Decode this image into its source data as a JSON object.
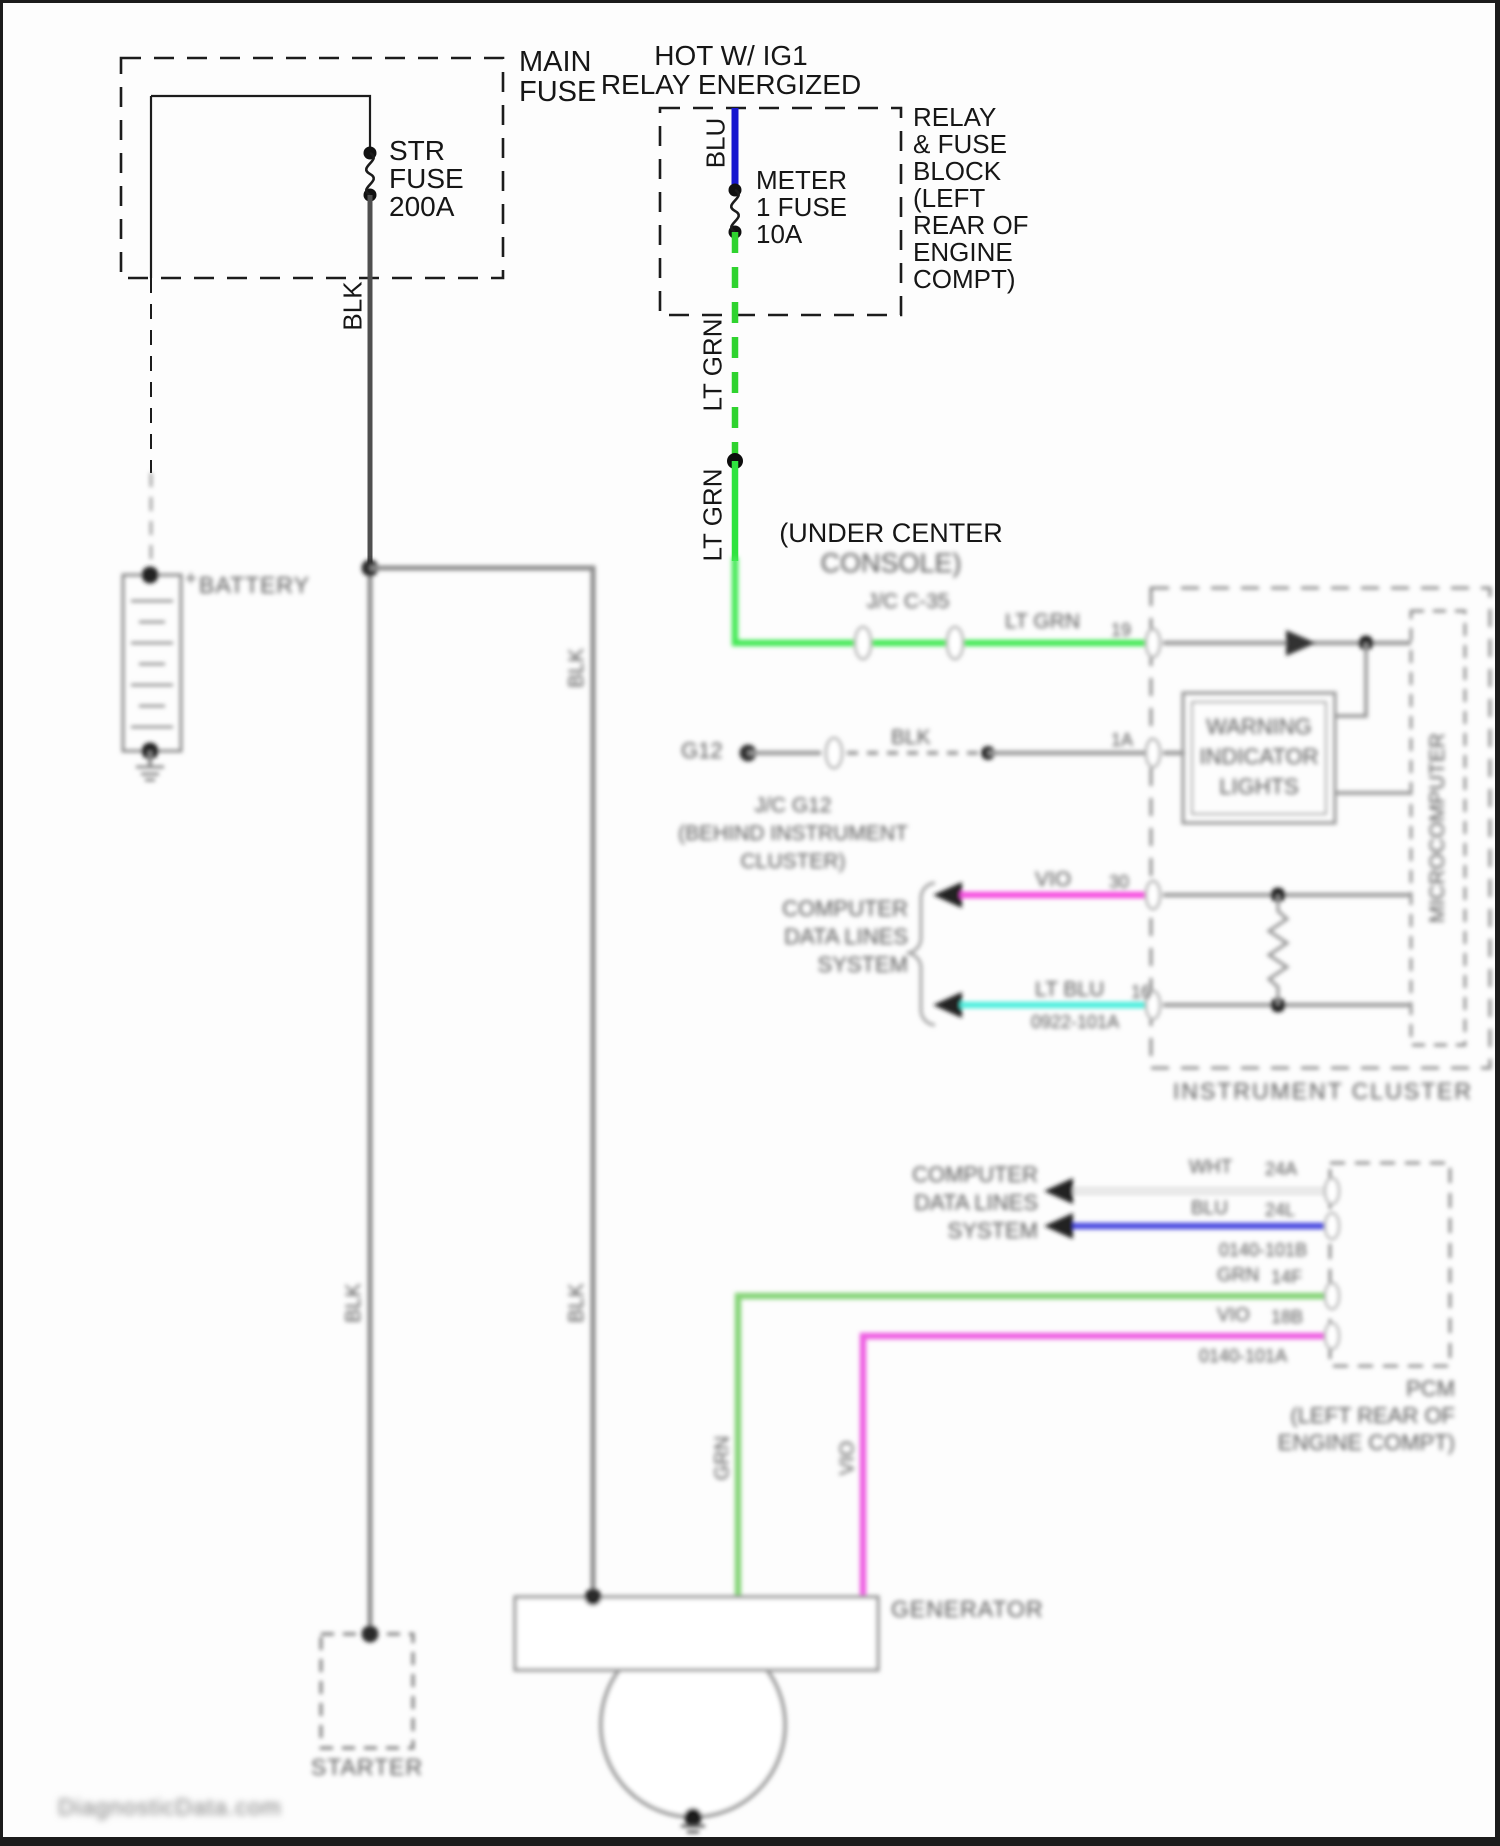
{
  "top": {
    "main_fuse": [
      "MAIN",
      "FUSE"
    ],
    "str_fuse": [
      "STR",
      "FUSE",
      "200A"
    ],
    "hot_header": [
      "HOT W/ IG1",
      "RELAY ENERGIZED"
    ],
    "relay_block": [
      "RELAY",
      "& FUSE",
      "BLOCK",
      "(LEFT",
      "REAR OF",
      "ENGINE",
      "COMPT)"
    ],
    "meter_fuse": [
      "METER",
      "1 FUSE",
      "10A"
    ],
    "blu": "BLU",
    "blk": "BLK",
    "lt_grn_upper": "LT GRN",
    "lt_grn_lower": "LT GRN",
    "under_center": [
      "(UNDER CENTER",
      "CONSOLE)"
    ]
  },
  "left": {
    "battery_plus": "+",
    "battery": "BATTERY",
    "starter": "STARTER",
    "blk_main_lower": "BLK",
    "blk_branch_upper": "BLK",
    "blk_branch_lower": "BLK"
  },
  "cluster": {
    "jc_c35": "J/C C-35",
    "lt_grn": "LT GRN",
    "lt_grn_pin": "19",
    "g12": "G12",
    "blk": "BLK",
    "blk_pin": "1A",
    "jc_g12": [
      "J/C G12",
      "(BEHIND INSTRUMENT",
      "CLUSTER)"
    ],
    "computer_data_lines": [
      "COMPUTER",
      "DATA LINES",
      "SYSTEM"
    ],
    "vio": "VIO",
    "vio_pin": "30",
    "lt_blu": "LT BLU",
    "lt_blu_pin": "16",
    "lt_blu_code": "0922-101A",
    "warning": [
      "WARNING",
      "INDICATOR",
      "LIGHTS"
    ],
    "microcomputer": "MICROCOMPUTER",
    "title": "INSTRUMENT CLUSTER"
  },
  "pcm": {
    "computer_data_lines": [
      "COMPUTER",
      "DATA LINES",
      "SYSTEM"
    ],
    "wht": "WHT",
    "wht_pin": "24A",
    "blu": "BLU",
    "blu_pin": "24L",
    "code_b": "0140-101B",
    "grn": "GRN",
    "grn_pin": "14F",
    "vio": "VIO",
    "vio_pin": "18B",
    "code_a": "0140-101A",
    "title": [
      "PCM",
      "(LEFT REAR OF",
      "ENGINE COMPT)"
    ]
  },
  "bottom": {
    "generator": "GENERATOR",
    "grn": "GRN",
    "vio": "VIO",
    "watermark": "DiagnosticData.com"
  },
  "colors": {
    "blk_wire": "#4f4f4f",
    "blk_wire_blur": "#8b8b8b",
    "blu_wire": "#1717cf",
    "lt_grn_wire": "#2fd32f",
    "grn_wire": "#86d478",
    "vio_wire": "#f153e2",
    "lt_blu_wire": "#4feede",
    "wht_wire": "#e6e6e6",
    "gray_wire": "#9a9a9a"
  }
}
